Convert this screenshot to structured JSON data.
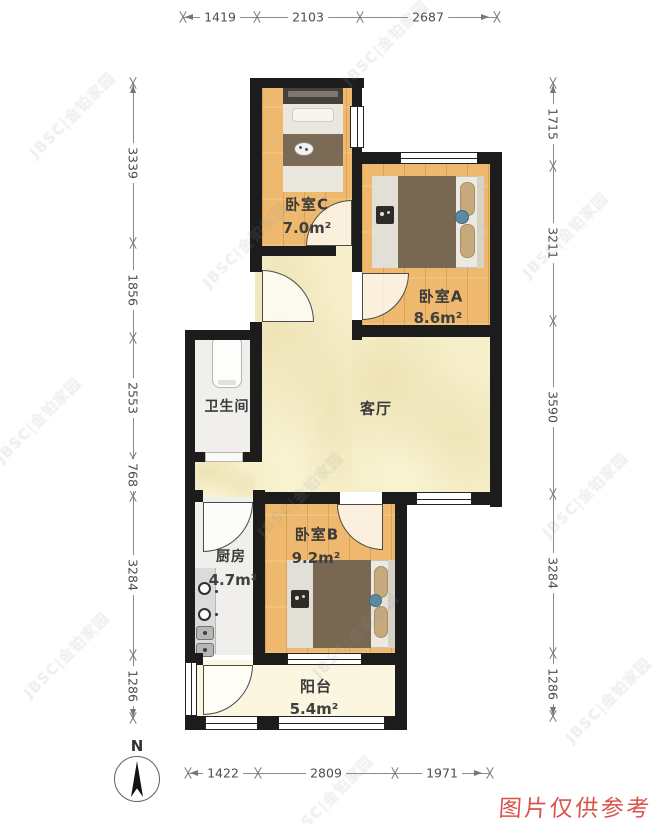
{
  "plan": {
    "rooms": {
      "bedroom_c": {
        "name": "卧室C",
        "area": "7.0m²"
      },
      "bedroom_a": {
        "name": "卧室A",
        "area": "8.6m²"
      },
      "bedroom_b": {
        "name": "卧室B",
        "area": "9.2m²"
      },
      "living_room": {
        "name": "客厅"
      },
      "bathroom": {
        "name": "卫生间"
      },
      "kitchen": {
        "name": "厨房",
        "area": "4.7m²"
      },
      "balcony": {
        "name": "阳台",
        "area": "5.4m²"
      }
    },
    "dimensions_mm": {
      "top": [
        "1419",
        "2103",
        "2687"
      ],
      "bottom": [
        "1422",
        "2809",
        "1971"
      ],
      "left": [
        "3339",
        "1856",
        "2553",
        "768",
        "3284",
        "1286"
      ],
      "right": [
        "1715",
        "3211",
        "3590",
        "3284",
        "1286"
      ]
    },
    "compass": {
      "label": "N"
    },
    "watermark": "JBSC|金铂家园",
    "disclaimer": "图片仅供参考",
    "colors": {
      "wall": "#1c1c1c",
      "wood_floor": "#eeb96e",
      "living_floor": "#f6efca",
      "tile_floor": "#f0efec",
      "balcony_floor": "#faf6df",
      "disclaimer_red": "#d9544b"
    }
  }
}
